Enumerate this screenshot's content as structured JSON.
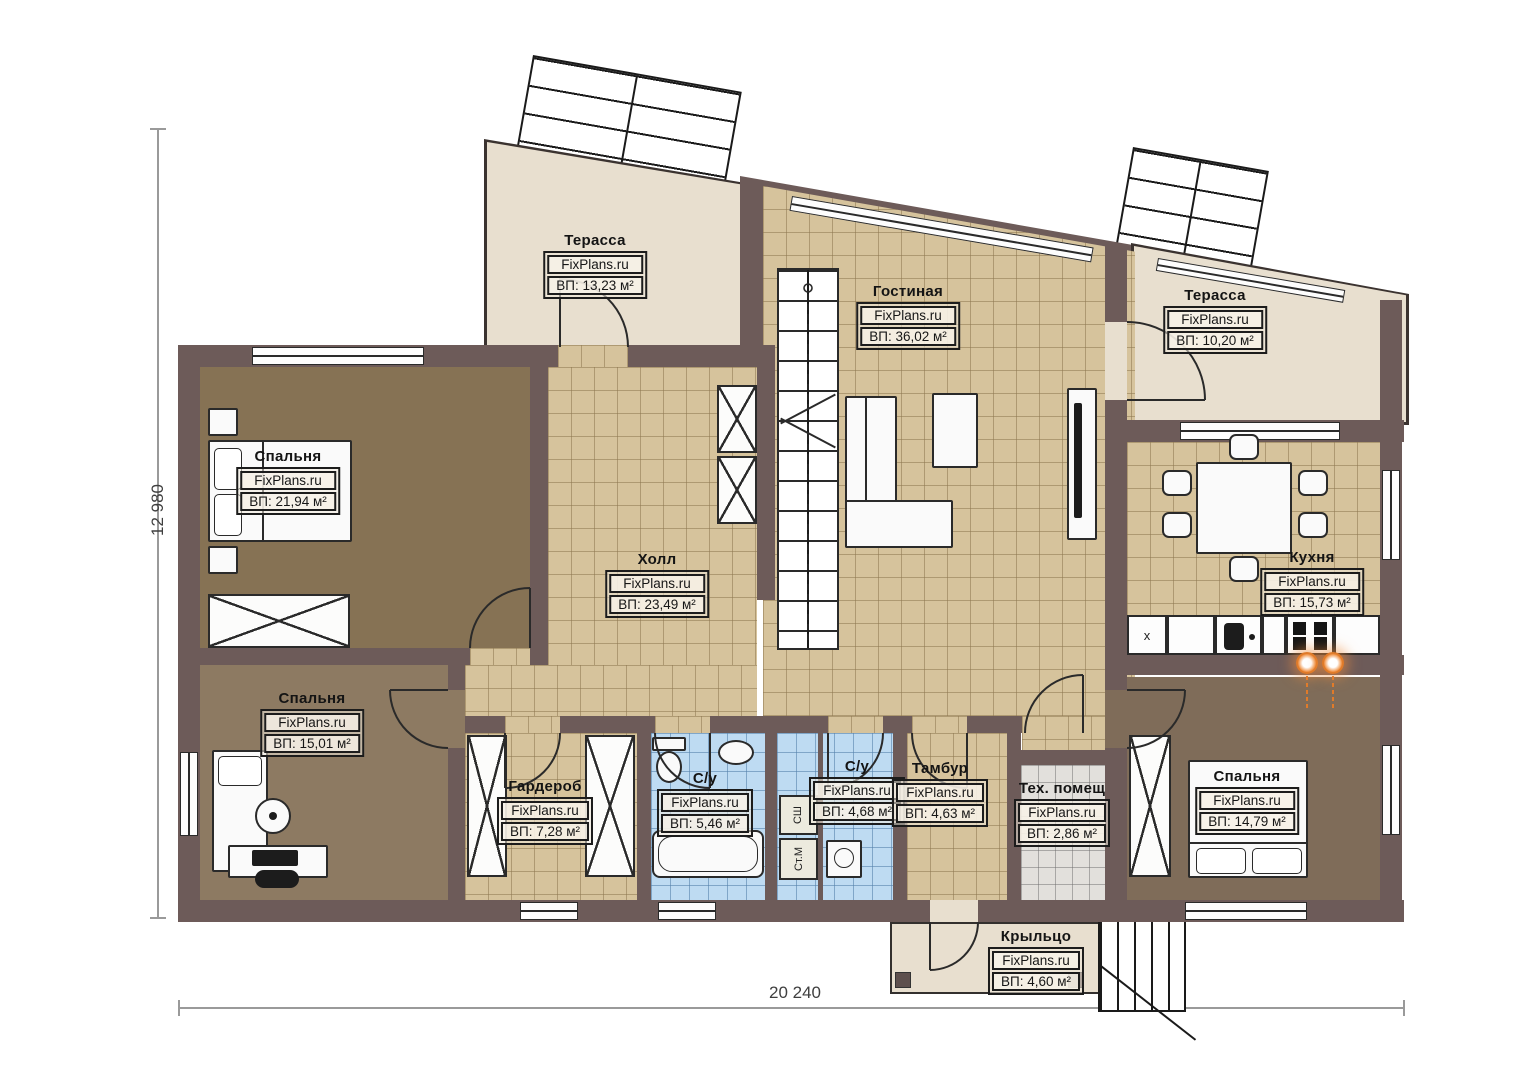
{
  "plan": {
    "watermark": "FixPlans.ru",
    "rooms": [
      {
        "id": "terrace-left",
        "name": "Терасса",
        "area": "ВП: 13,23 м²"
      },
      {
        "id": "living-room",
        "name": "Гостиная",
        "area": "ВП: 36,02 м²"
      },
      {
        "id": "terrace-right",
        "name": "Терасса",
        "area": "ВП: 10,20 м²"
      },
      {
        "id": "bedroom-1",
        "name": "Спальня",
        "area": "ВП: 21,94 м²"
      },
      {
        "id": "hall",
        "name": "Холл",
        "area": "ВП: 23,49 м²"
      },
      {
        "id": "kitchen",
        "name": "Кухня",
        "area": "ВП: 15,73 м²"
      },
      {
        "id": "bedroom-2",
        "name": "Спальня",
        "area": "ВП: 15,01 м²"
      },
      {
        "id": "wardrobe",
        "name": "Гардероб",
        "area": "ВП: 7,28 м²"
      },
      {
        "id": "bathroom-1",
        "name": "С/у",
        "area": "ВП: 5,46 м²"
      },
      {
        "id": "bathroom-2",
        "name": "С/у",
        "area": "ВП: 4,68 м²"
      },
      {
        "id": "tambour",
        "name": "Тамбур",
        "area": "ВП: 4,63 м²"
      },
      {
        "id": "tech-room",
        "name": "Тех. помещ",
        "area": "ВП: 2,86 м²"
      },
      {
        "id": "bedroom-3",
        "name": "Спальня",
        "area": "ВП: 14,79 м²"
      },
      {
        "id": "porch",
        "name": "Крыльцо",
        "area": "ВП: 4,60 м²"
      }
    ],
    "dimensions": {
      "vertical": "12 980",
      "horizontal": "20 240"
    },
    "annotations": {
      "closet_top": "СШ",
      "closet_bottom": "Ст.М",
      "kitchen_cabinet": "x"
    },
    "colors": {
      "wall": "#6d5b59",
      "tile_floor": "#d6c39c",
      "terrace_floor": "#e8dfcf",
      "bathroom_floor": "#bedbf2",
      "tech_floor": "#e2e0dc",
      "bedroom1_floor": "#867254",
      "bedroom2_floor": "#8d7a62",
      "bedroom3_floor": "#7f6c59",
      "stool_accent": "#e07b2a"
    }
  }
}
